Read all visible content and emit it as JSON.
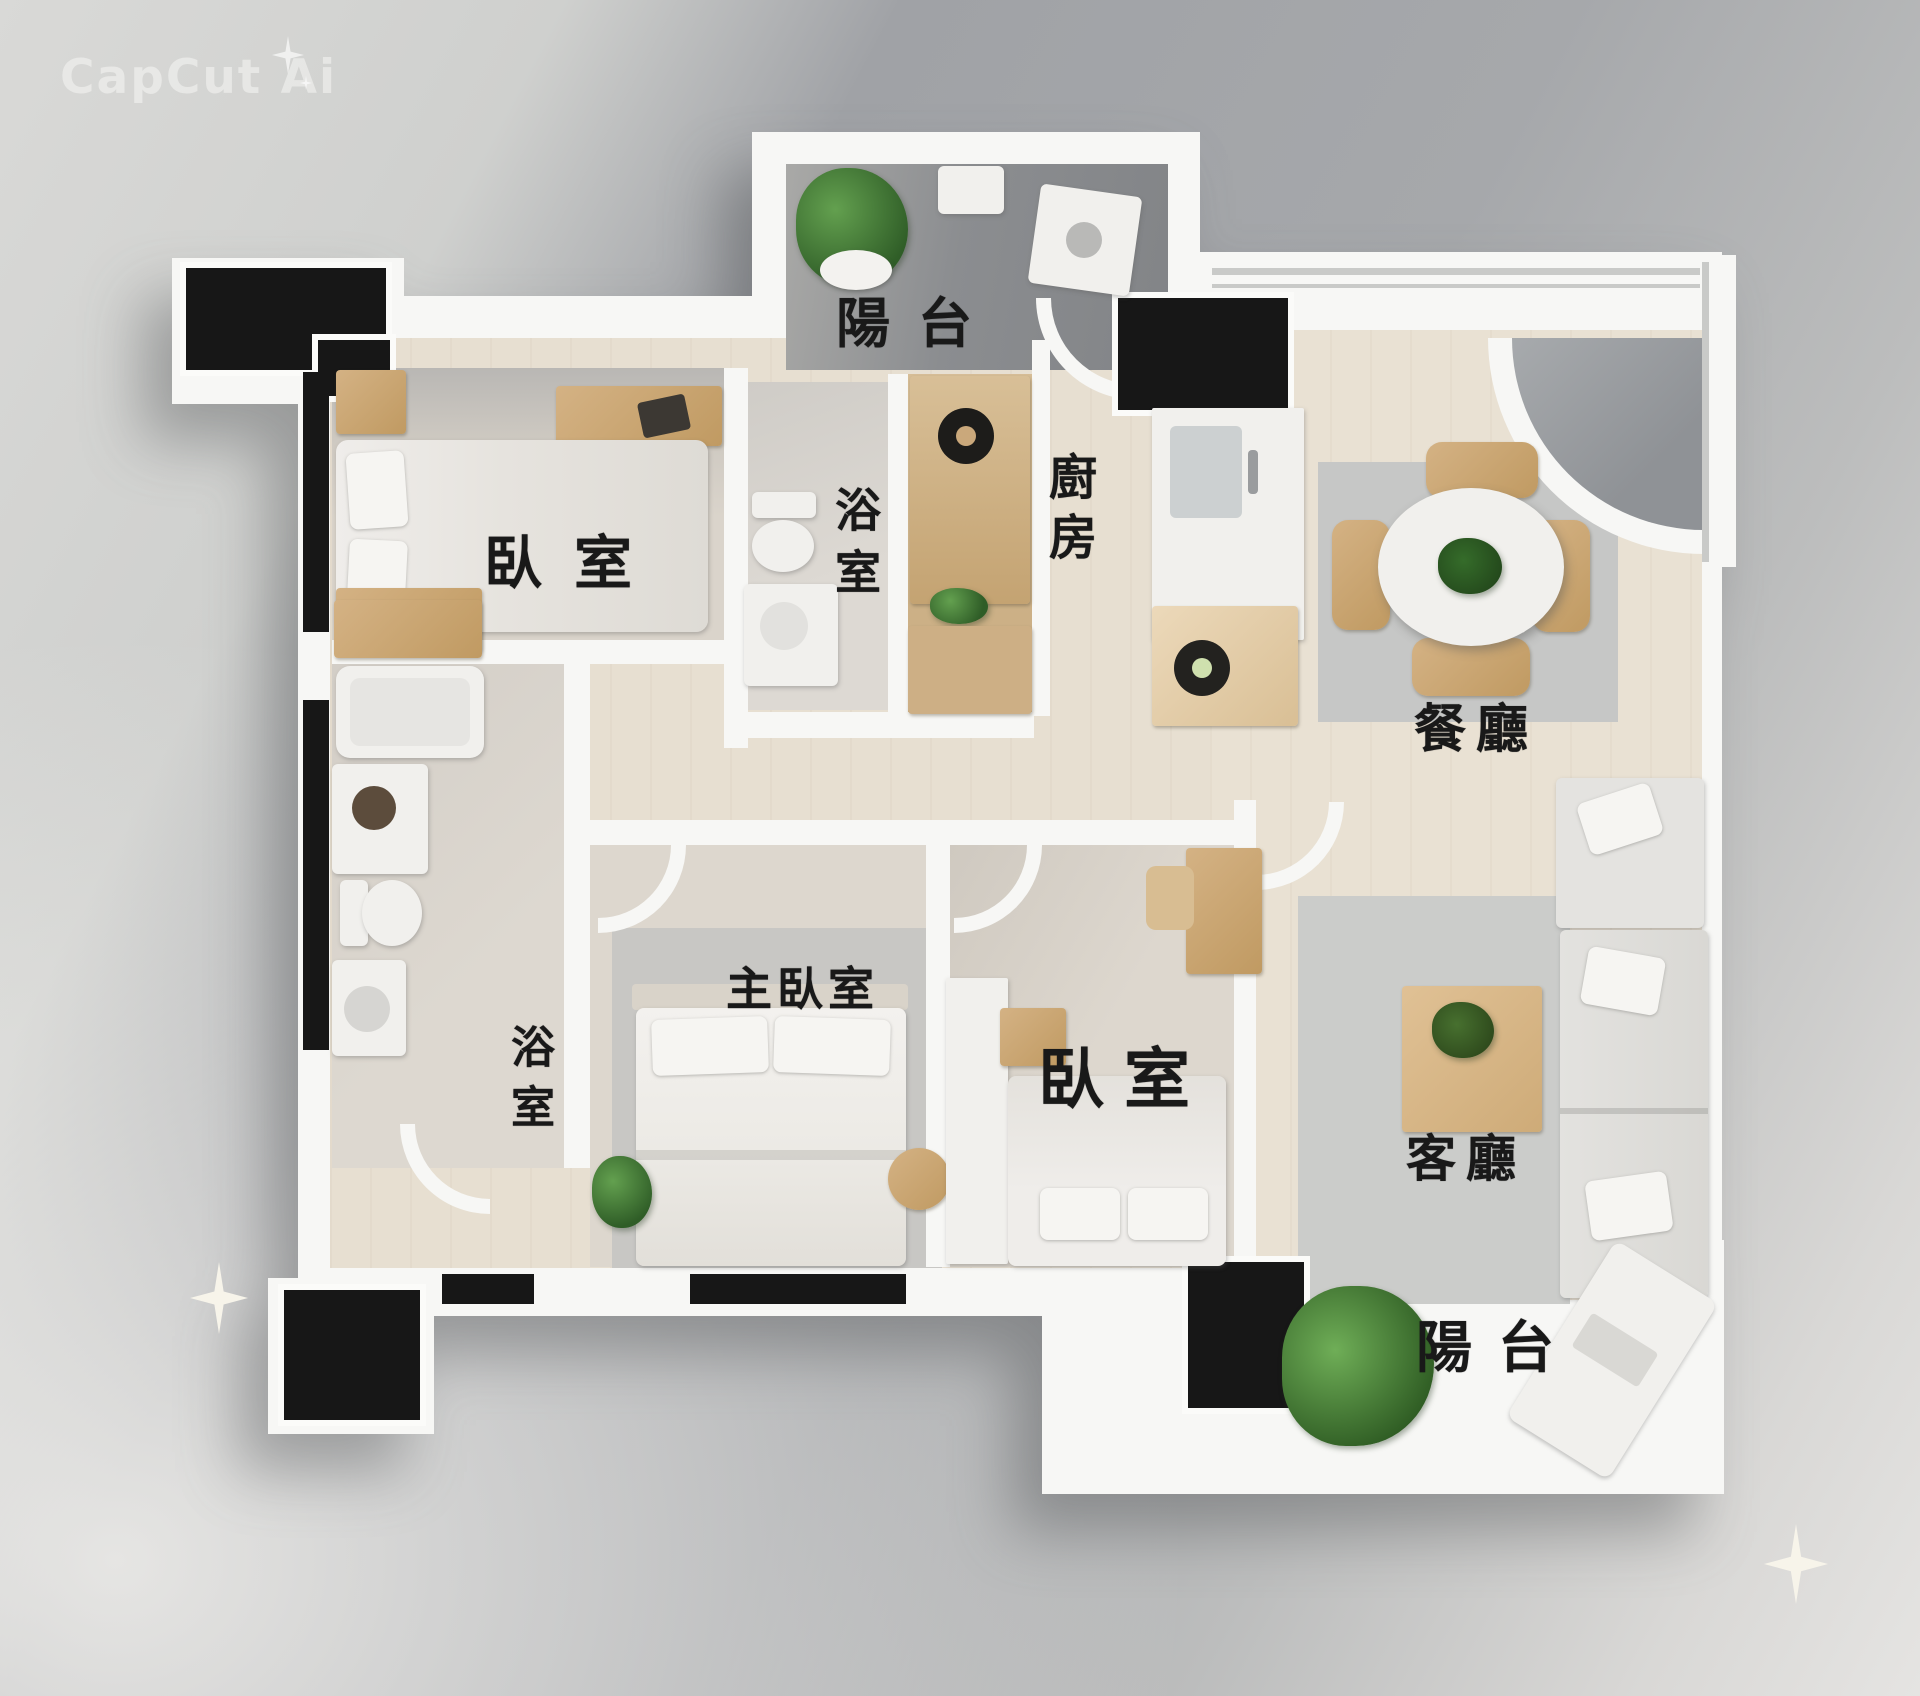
{
  "watermark": {
    "brand": "CapCut Ai",
    "sparkle_icon": "four-point-star"
  },
  "plan": {
    "rooms": {
      "balcony_top": {
        "label": "陽台",
        "type": "balcony"
      },
      "bedroom_top": {
        "label": "臥室",
        "type": "bedroom"
      },
      "bathroom_top": {
        "label": "浴室",
        "type": "bathroom",
        "orientation": "vertical"
      },
      "kitchen": {
        "label": "廚房",
        "type": "kitchen",
        "orientation": "vertical"
      },
      "dining": {
        "label": "餐廳",
        "type": "dining-room"
      },
      "master_bedroom": {
        "label": "主臥室",
        "type": "bedroom"
      },
      "bathroom_left": {
        "label": "浴室",
        "type": "bathroom",
        "orientation": "vertical"
      },
      "bedroom_bottom": {
        "label": "臥室",
        "type": "bedroom"
      },
      "living": {
        "label": "客廳",
        "type": "living-room"
      },
      "balcony_bottom": {
        "label": "陽台",
        "type": "balcony"
      }
    },
    "colors": {
      "wall": "#f7f7f5",
      "structural_column": "#171717",
      "wood_floor": "#e7dfd1",
      "bedroom_floor": "#dad4cb",
      "bathroom_floor": "#d9d4cc",
      "balcony_floor_top": "#8e9093",
      "balcony_floor_bottom": "#d9d9d7",
      "rug": "#c6c7c6",
      "wood_furniture": "#c9a878",
      "plant_green": "#3f7a34",
      "label_ink": "#191919",
      "background_dark": "#a2a4a7",
      "background_light": "#e2e1df"
    }
  }
}
